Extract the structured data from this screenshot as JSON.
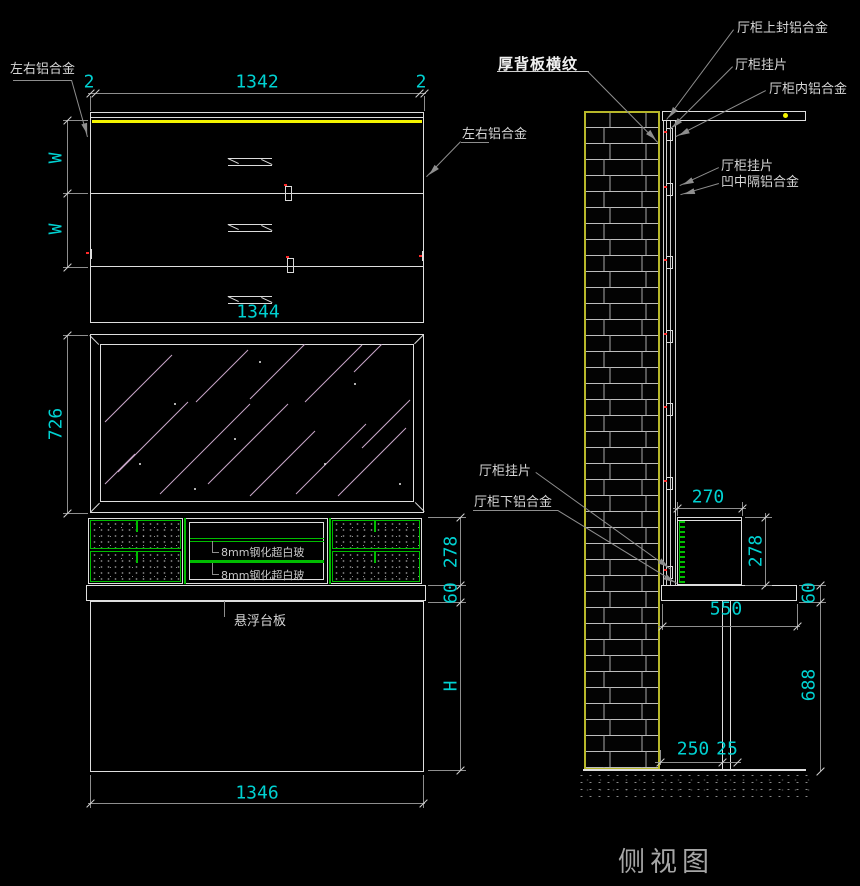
{
  "drawing": {
    "front": {
      "dim_top_width": "1342",
      "dim_edge_l": "2",
      "dim_edge_r": "2",
      "dim_w1": "W",
      "dim_w2": "W",
      "dim_mid_width": "1344",
      "dim_mirror_h": "726",
      "dim_panel_h": "278",
      "dim_counter_t": "60",
      "dim_lower_h": "H",
      "dim_bottom_width": "1346",
      "label_lr_alu_left": "左右铝合金",
      "label_lr_alu_right": "左右铝合金",
      "label_glass_1": "8mm钢化超白玻",
      "label_glass_2": "8mm钢化超白玻",
      "label_float": "悬浮台板"
    },
    "side": {
      "title": "侧视图",
      "note_back": "厚背板横纹",
      "label_top_seal": "厅柜上封铝合金",
      "label_hanger_1": "厅柜挂片",
      "label_inner_alu": "厅柜内铝合金",
      "label_hanger_2": "厅柜挂片",
      "label_mid_alu": "凹中隔铝合金",
      "label_hanger_3": "厅柜挂片",
      "label_bottom_alu": "厅柜下铝合金",
      "dim_box_w": "270",
      "dim_box_h": "278",
      "dim_counter_d": "550",
      "dim_counter_t": "60",
      "dim_leg_h": "688",
      "dim_base_a": "250",
      "dim_base_b": "25"
    },
    "colors": {
      "dim_text": "#00d2d2",
      "accent_yellow": "#f5f500",
      "accent_green": "#00bd00",
      "wall_outline": "#b8b82a",
      "mirror_hatch": "#c9a6c9",
      "clip_red": "#ff2a2a"
    }
  }
}
